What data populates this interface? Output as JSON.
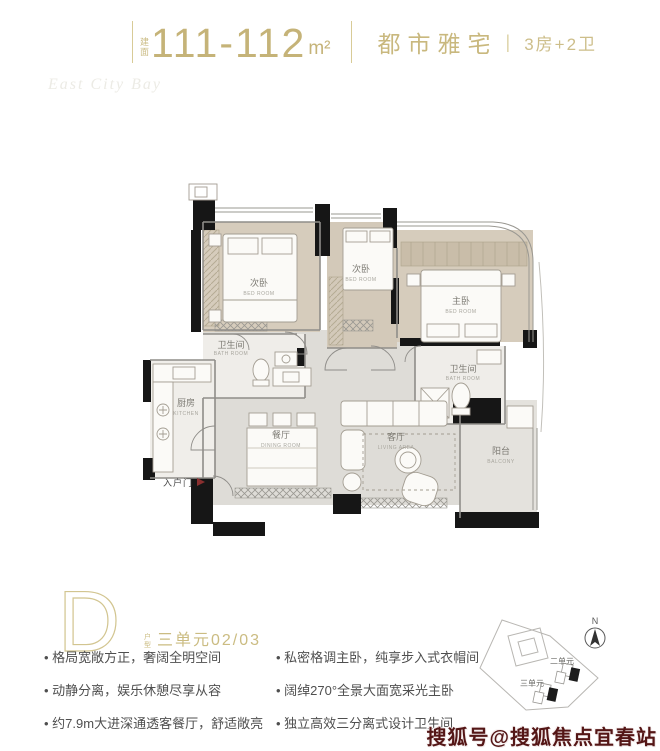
{
  "header": {
    "area_prefix": "建面",
    "area_value": "111-112",
    "area_unit": "m²",
    "project_type": "都市雅宅",
    "separator": "|",
    "layout": "3房+2卫"
  },
  "decor": {
    "script_text": "East City Bay"
  },
  "floor_plan": {
    "rooms": [
      {
        "cn": "次卧",
        "en": "BED ROOM"
      },
      {
        "cn": "次卧",
        "en": "BED ROOM"
      },
      {
        "cn": "主卧",
        "en": "BED ROOM"
      },
      {
        "cn": "卫生间",
        "en": "BATH ROOM"
      },
      {
        "cn": "卫生间",
        "en": "BATH ROOM"
      },
      {
        "cn": "厨房",
        "en": "KITCHEN"
      },
      {
        "cn": "餐厅",
        "en": "DINING ROOM"
      },
      {
        "cn": "客厅",
        "en": "LIVING AREA"
      },
      {
        "cn": "阳台",
        "en": "BALCONY"
      }
    ],
    "entrance_label": "入户门"
  },
  "unit_info": {
    "letter": "D",
    "letter_suffix": "户型",
    "unit_text": "三单元02/03"
  },
  "features": {
    "left": [
      "格局宽敞方正，奢阔全明空间",
      "动静分离，娱乐休憩尽享从容",
      "约7.9m大进深通透客餐厅，舒适敞亮"
    ],
    "right": [
      "私密格调主卧，纯享步入式衣帽间",
      "阔绰270°全景大面宽采光主卧",
      "独立高效三分离式设计卫生间"
    ]
  },
  "site_plan": {
    "north_label": "N",
    "buildings": [
      "二单元",
      "三单元"
    ]
  },
  "watermark": "搜狐号@搜狐焦点宜春站",
  "colors": {
    "gold": "#c8b77d",
    "feature_text": "#4f4f4f",
    "watermark_red": "#541616",
    "wall_black": "#161616",
    "bedroom_floor": "#d6ccbc",
    "living_floor": "#dedcd7"
  }
}
